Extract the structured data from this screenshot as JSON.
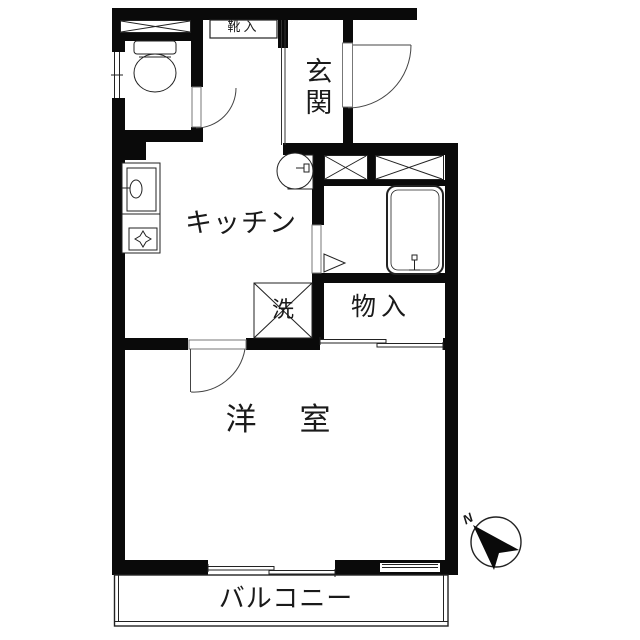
{
  "rooms": {
    "entrance": {
      "label": "玄関"
    },
    "kitchen": {
      "label": "キッチン"
    },
    "western_room": {
      "label": "洋　室"
    },
    "storage": {
      "label": "物入"
    },
    "laundry": {
      "label": "洗"
    },
    "shoe_cabinet": {
      "label": "靴入"
    },
    "balcony": {
      "label": "バルコニー"
    }
  },
  "compass": {
    "north_label": "N",
    "needle_points": "northwest"
  },
  "colors": {
    "wall": "#0a0a0a",
    "background": "#ffffff",
    "thin_line": "#333333"
  }
}
